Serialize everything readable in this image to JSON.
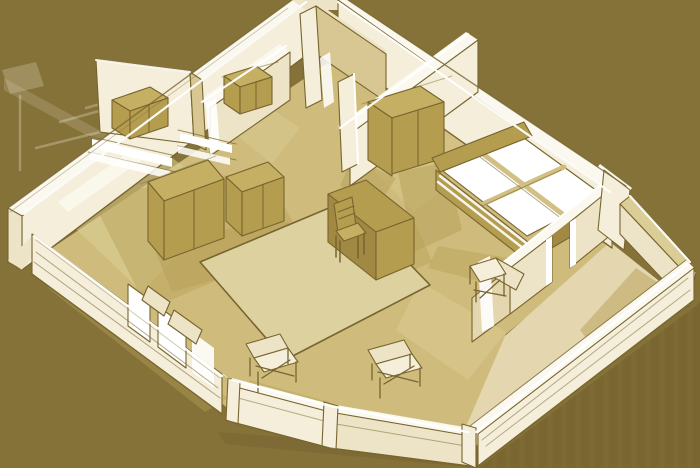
{
  "meta": {
    "title": "Isometric apartment floor-plan sketch",
    "style": "monochrome sepia 3D cutaway illustration, hand-drawn look",
    "view": "axonometric from above, walls cut to half height"
  },
  "palette": {
    "background": "#857239",
    "shadow": "#6F5D2A",
    "wall_light": "#F4EEDA",
    "wall_mid": "#EDE3C6",
    "wall_shade": "#E4D6AE",
    "wall_deep": "#D8C693",
    "wall_top": "#FBF9EF",
    "white": "#FFFFFF",
    "floor": "#CFBC7C",
    "floor_light": "#DBCD96",
    "floor_shadow": "#B5A057",
    "rug": "#DDD1A0",
    "furn": "#B59D4F",
    "furn_light": "#C5AF62",
    "furn_dark": "#A18944",
    "outline": "#77652E"
  },
  "scene": {
    "building": "one-bedroom apartment with balcony",
    "rooms": [
      {
        "id": "living-room",
        "furniture": [
          "sideboard",
          "rug",
          "desk",
          "desk-chair",
          "armchair-left",
          "armchair-right",
          "armchair-corner",
          "window-benches"
        ]
      },
      {
        "id": "bedroom",
        "furniture": [
          "wardrobe",
          "double-bed-with-white-bedding"
        ]
      },
      {
        "id": "kitchen-room",
        "furniture": [
          "tall-cupboard",
          "dresser",
          "counter-with-lit-top"
        ]
      },
      {
        "id": "hallway",
        "furniture": [
          "low-cabinet"
        ]
      },
      {
        "id": "bathroom",
        "furniture": []
      },
      {
        "id": "balcony",
        "furniture": []
      }
    ],
    "lighting": "windows on lower-left wall shown as white panes; long drop shadow cast to lower-right"
  }
}
